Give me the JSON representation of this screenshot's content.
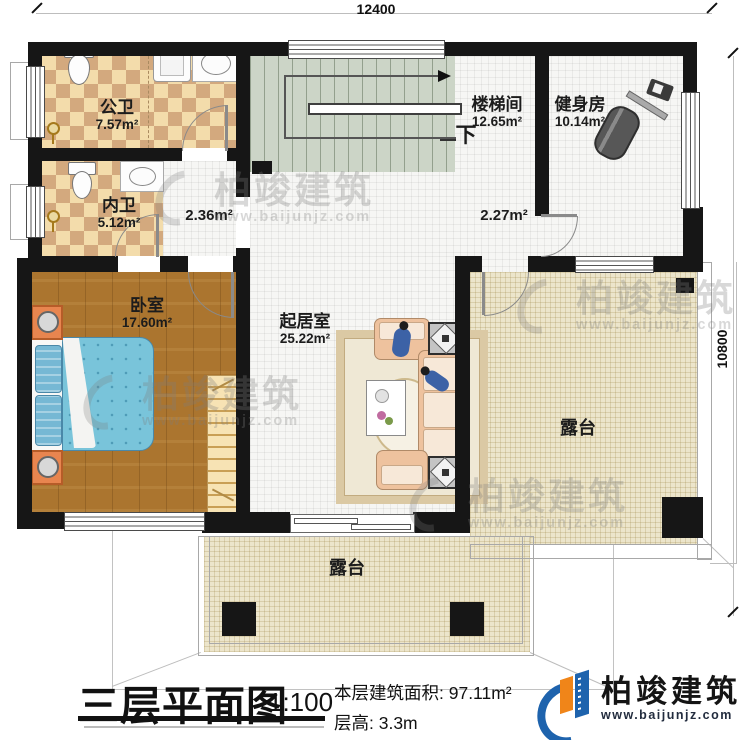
{
  "plan": {
    "dimensions": {
      "width_label": "12400",
      "height_label": "10800"
    },
    "rooms": {
      "public_bath": {
        "name": "公卫",
        "area": "7.57m²"
      },
      "ensuite_bath": {
        "name": "内卫",
        "area": "5.12m²"
      },
      "bedroom": {
        "name": "卧室",
        "area": "17.60m²"
      },
      "stair_hall": {
        "name": "楼梯间",
        "area": "12.65m²"
      },
      "gym": {
        "name": "健身房",
        "area": "10.14m²"
      },
      "living_room": {
        "name": "起居室",
        "area": "25.22m²"
      },
      "terrace_right": {
        "name": "露台"
      },
      "terrace_bottom": {
        "name": "露台"
      }
    },
    "annotations": {
      "hall_area_left": "2.36m²",
      "hall_area_right": "2.27m²",
      "stairs_direction": "下"
    }
  },
  "footer": {
    "title": "三层平面图",
    "scale": "1:100",
    "floor_area": "本层建筑面积: 97.11m²",
    "floor_height": "层高: 3.3m"
  },
  "brand": {
    "name": "柏竣建筑",
    "website": "www.baijunjz.com"
  },
  "watermark": {
    "name": "柏竣建筑",
    "website": "www.baijunjz.com"
  },
  "colors": {
    "wall": "#161616",
    "checker_light": "#f3dcab",
    "checker_dark": "#d3a97e",
    "stairs": "#ccd5c7",
    "wood": "#ab752f",
    "terrace": "#ece5cb",
    "bed": "#79c4da",
    "logo_blue": "#1e63ad",
    "logo_orange": "#f08519"
  }
}
